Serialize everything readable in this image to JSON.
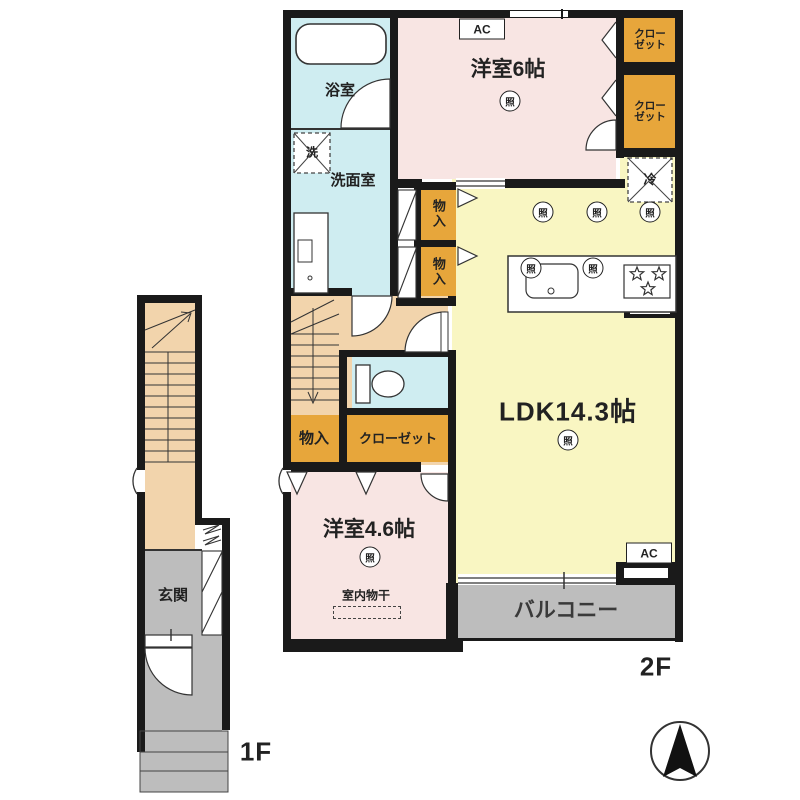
{
  "plan": {
    "floor_tags": {
      "second": "2F",
      "first": "1F"
    },
    "rooms": {
      "bathroom": "浴室",
      "washroom": "洗面室",
      "bedroom6": "洋室6帖",
      "ldk": "LDK14.3帖",
      "bedroom46": "洋室4.6帖",
      "balcony": "バルコニー",
      "entrance": "玄関"
    },
    "storage": {
      "closet_l1": "クロー",
      "closet_l2": "ゼット",
      "closet": "クローゼット",
      "monoiri": "物入"
    },
    "fixtures": {
      "ac": "AC",
      "light": "照",
      "washer": "洗",
      "fridge": "冷",
      "drying": "室内物干"
    },
    "colors": {
      "wall": "#1a1a1a",
      "western_room": "#f8e5e3",
      "ldk": "#f9f6c2",
      "wet_area": "#cfedf1",
      "hall": "#f2d4ac",
      "storage": "#e7a63b",
      "outdoor": "#bdbdbd"
    }
  }
}
